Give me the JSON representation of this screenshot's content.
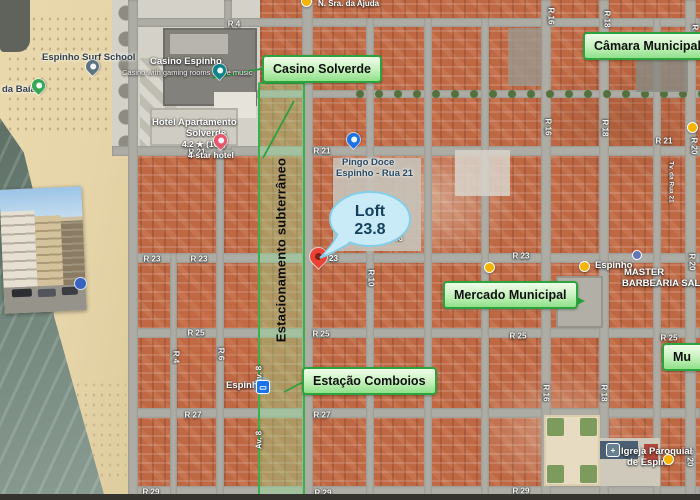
{
  "annotations": {
    "casino_box": "Casino Solverde",
    "camara_box": "Câmara Municipal",
    "mercado_box": "Mercado Municipal",
    "estacao_box": "Estação Comboios",
    "museu_box_partial": "Mu",
    "parking_strip": "Estacionamento subterrâneo",
    "accent_green": "#2ca33d"
  },
  "balloon": {
    "line1": "Loft",
    "line2": "23.8",
    "fill": "#c8ebf7",
    "text_color": "#14405e"
  },
  "pois": {
    "surf_school": "Espinho Surf School",
    "praia_partial": "da Baía",
    "casino_title": "Casino Espinho",
    "casino_sub": "Casino with gaming rooms & live music",
    "hotel_line1": "Hotel Apartamento",
    "hotel_line2": "Solverde",
    "hotel_rating": "4.2 ★ (165)",
    "hotel_type": "4-star hotel",
    "pingo_line1": "Pingo Doce",
    "pingo_line2": "Espinho - Rua 21",
    "station": "Espinho",
    "stop_espinho": "Espinho",
    "barber_line1": "MASTER",
    "barber_line2": "BARBEARIA SALON",
    "igreja_line1": "Igreja Paroquial",
    "igreja_line2": "de Espin",
    "top_label": "N. Sra. da Ajuda",
    "pin_street_no": "23"
  },
  "street_labels": [
    {
      "t": "R 4",
      "x": 234,
      "y": 24,
      "r": 0
    },
    {
      "t": "R 21",
      "x": 197,
      "y": 152,
      "r": 0
    },
    {
      "t": "R 21",
      "x": 322,
      "y": 151,
      "r": 0
    },
    {
      "t": "R 21",
      "x": 664,
      "y": 141,
      "r": 0
    },
    {
      "t": "R 23",
      "x": 152,
      "y": 259,
      "r": 0
    },
    {
      "t": "R 23",
      "x": 199,
      "y": 259,
      "r": 0
    },
    {
      "t": "R 23",
      "x": 521,
      "y": 256,
      "r": 0
    },
    {
      "t": "R 25",
      "x": 196,
      "y": 333,
      "r": 0
    },
    {
      "t": "R 25",
      "x": 321,
      "y": 334,
      "r": 0
    },
    {
      "t": "R 25",
      "x": 518,
      "y": 336,
      "r": 0
    },
    {
      "t": "R 25",
      "x": 669,
      "y": 338,
      "r": 0
    },
    {
      "t": "R 27",
      "x": 193,
      "y": 415,
      "r": 0
    },
    {
      "t": "R 27",
      "x": 322,
      "y": 415,
      "r": 0
    },
    {
      "t": "R 29",
      "x": 151,
      "y": 492,
      "r": 0
    },
    {
      "t": "R 29",
      "x": 323,
      "y": 493,
      "r": 0
    },
    {
      "t": "R 29",
      "x": 521,
      "y": 491,
      "r": 0
    },
    {
      "t": "R 16",
      "x": 551,
      "y": 16,
      "r": 90
    },
    {
      "t": "R 16",
      "x": 548,
      "y": 127,
      "r": 90
    },
    {
      "t": "R 16",
      "x": 546,
      "y": 393,
      "r": 90
    },
    {
      "t": "R 18",
      "x": 607,
      "y": 19,
      "r": 90
    },
    {
      "t": "R 18",
      "x": 605,
      "y": 128,
      "r": 90
    },
    {
      "t": "R 18",
      "x": 604,
      "y": 393,
      "r": 90
    },
    {
      "t": "R 20",
      "x": 695,
      "y": 33,
      "r": 90
    },
    {
      "t": "R 20",
      "x": 694,
      "y": 146,
      "r": 90
    },
    {
      "t": "R 20",
      "x": 692,
      "y": 262,
      "r": 90
    },
    {
      "t": "R 20",
      "x": 690,
      "y": 458,
      "r": 90
    },
    {
      "t": "Tv. da Rua 21",
      "x": 671,
      "y": 182,
      "r": 90,
      "s": 6.5
    },
    {
      "t": "R 4",
      "x": 176,
      "y": 357,
      "r": 90
    },
    {
      "t": "R 6",
      "x": 221,
      "y": 354,
      "r": 90
    },
    {
      "t": "R 10",
      "x": 371,
      "y": 278,
      "r": 90
    },
    {
      "t": "R 12",
      "x": 399,
      "y": 233,
      "r": 90
    },
    {
      "t": "Av. 8",
      "x": 259,
      "y": 375,
      "r": -90
    },
    {
      "t": "Av. 8",
      "x": 259,
      "y": 440,
      "r": -90
    }
  ]
}
